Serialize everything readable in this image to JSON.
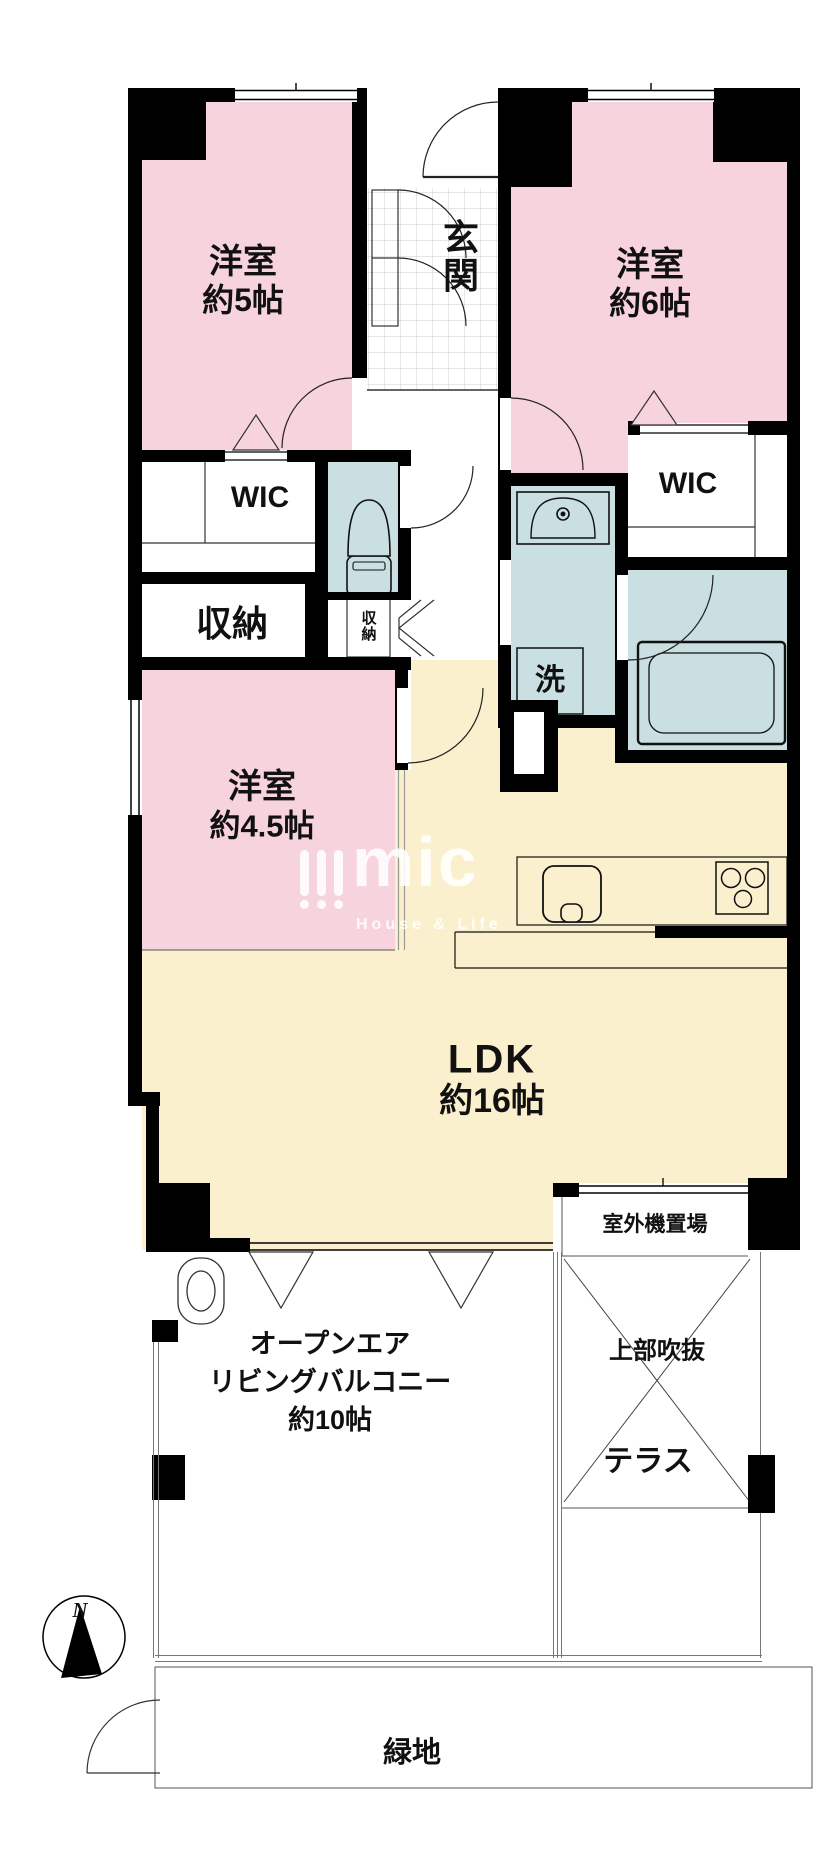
{
  "plan": {
    "rooms": {
      "room_5jo": {
        "name": "洋室",
        "size": "約5帖"
      },
      "room_6jo": {
        "name": "洋室",
        "size": "約6帖"
      },
      "room_45jo": {
        "name": "洋室",
        "size": "約4.5帖"
      },
      "ldk": {
        "name": "LDK",
        "size": "約16帖"
      },
      "entrance": {
        "name": "玄関"
      },
      "wic_left": {
        "name": "WIC"
      },
      "wic_right": {
        "name": "WIC"
      },
      "storage_left": {
        "name": "収納"
      },
      "storage_hall": {
        "name": "収納"
      },
      "laundry": {
        "name": "洗"
      },
      "outdoor_unit": {
        "name": "室外機置場"
      },
      "upper_void": {
        "name": "上部吹抜"
      },
      "terrace": {
        "name": "テラス"
      },
      "balcony": {
        "line1": "オープンエア",
        "line2": "リビングバルコニー",
        "line3": "約10帖"
      },
      "green_area": {
        "name": "緑地"
      }
    },
    "compass": {
      "label": "N"
    },
    "watermark": {
      "brand": "mic",
      "tagline": "House & Life"
    },
    "colors": {
      "room_pink": "#f7d3de",
      "ldk_cream": "#faf0cd",
      "wet_blue": "#c9dfe2",
      "wall_black": "#000000",
      "tile_gray": "#cccccc",
      "thin_line": "#555555"
    }
  }
}
